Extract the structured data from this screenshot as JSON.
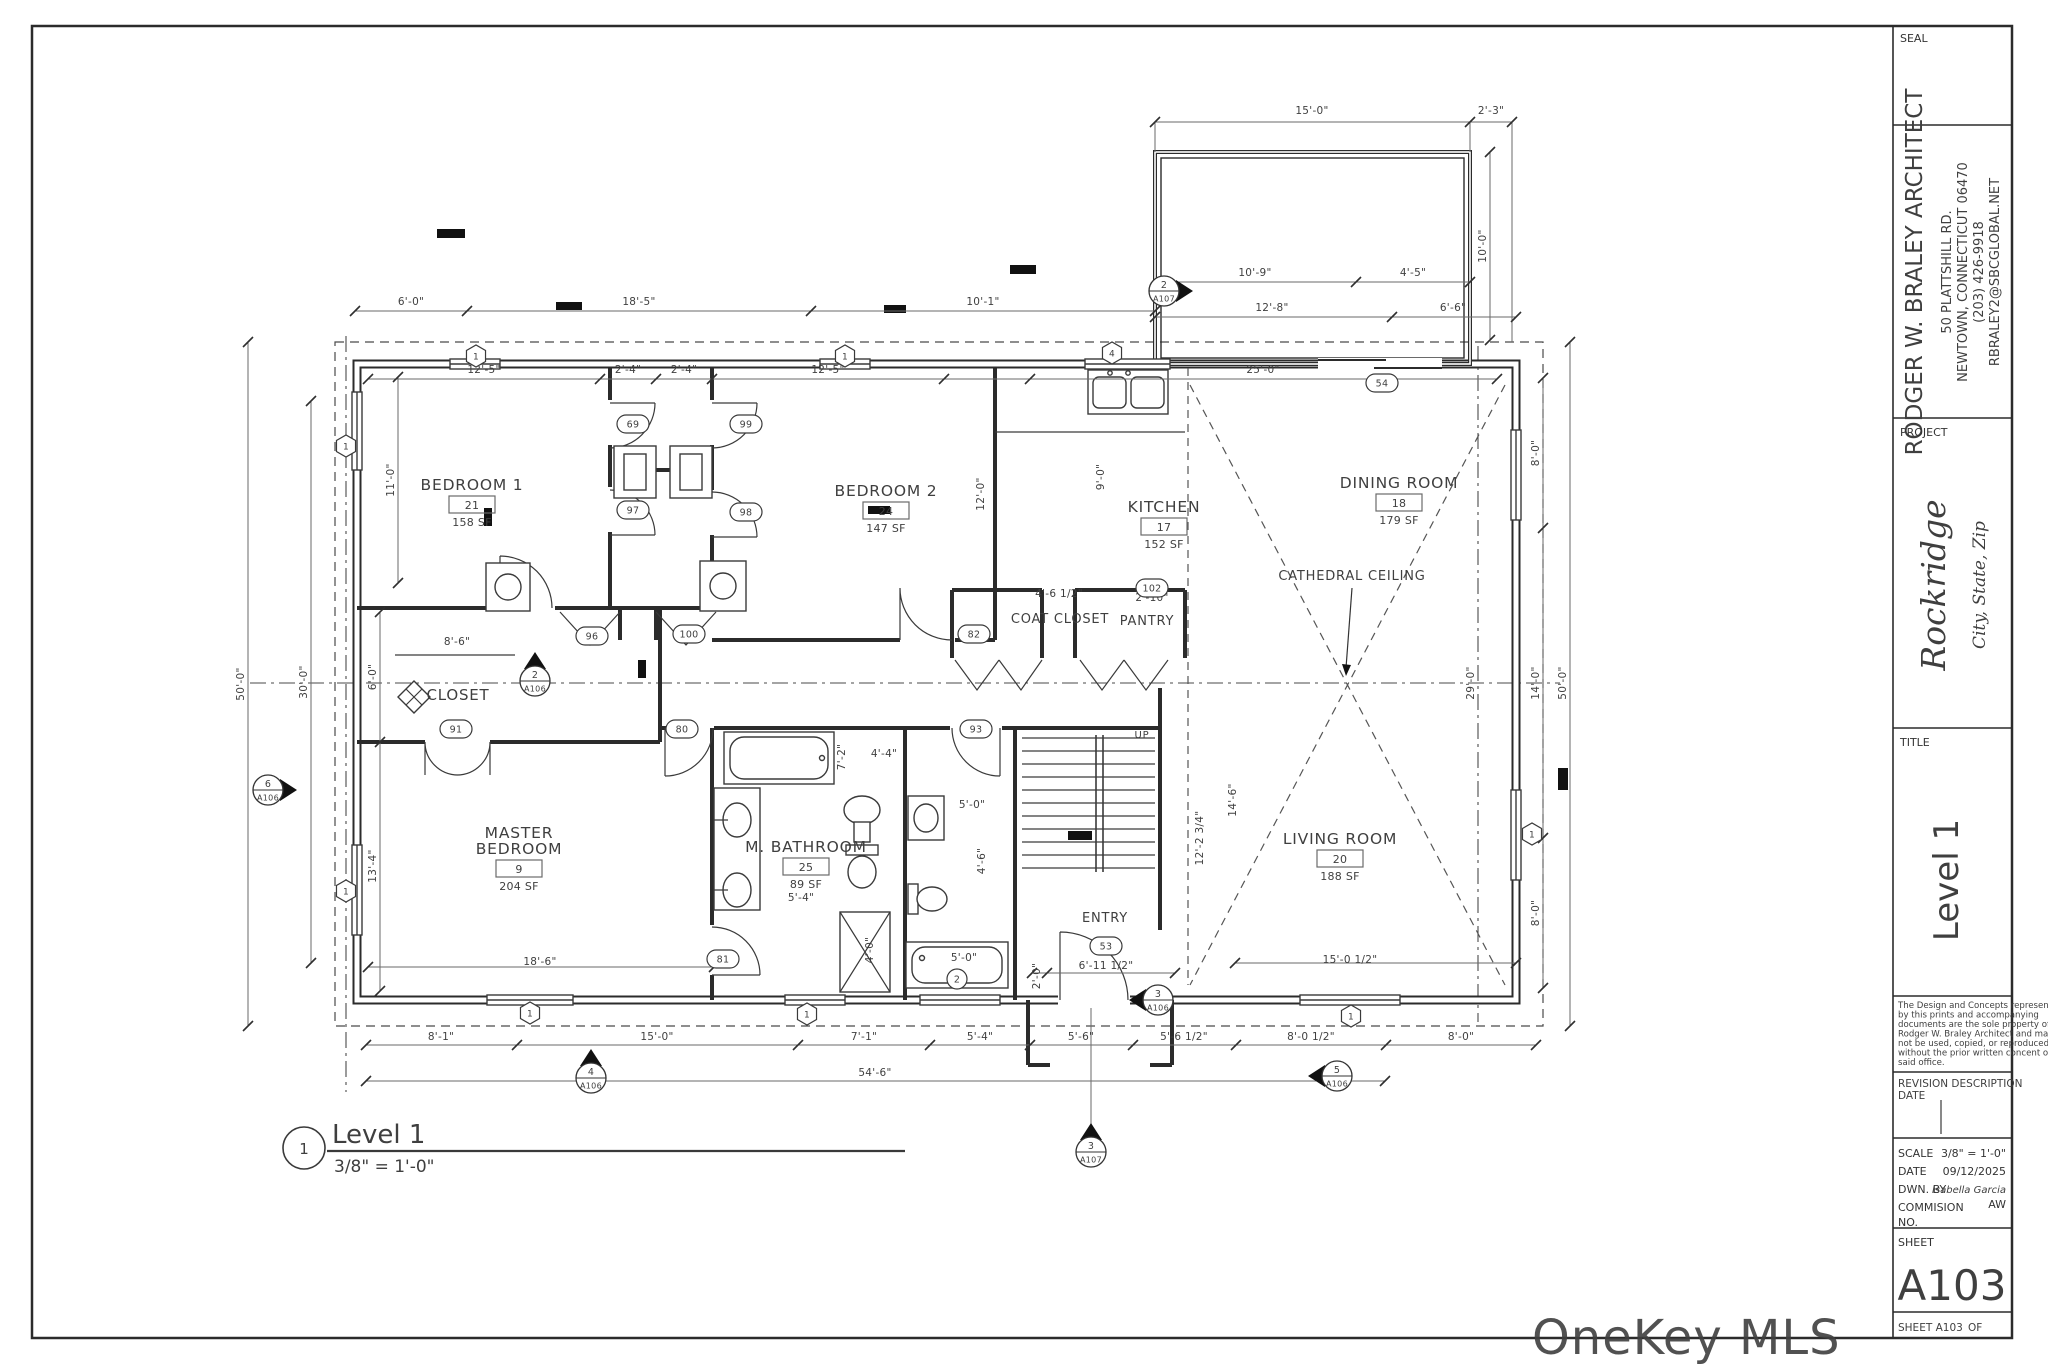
{
  "title_block": {
    "seal_label": "SEAL",
    "architect": {
      "name": "RODGER W. BRALEY ARCHITECT",
      "address1": "50 PLATTSHILL RD.",
      "address2": "NEWTOWN, CONNECTICUT 06470",
      "phone": "(203) 426-9918",
      "email": "RBRALEY2@SBCGLOBAL.NET"
    },
    "project_label": "PROJECT",
    "project_name": "Rockridge",
    "project_location": "City, State, Zip",
    "title_label": "TITLE",
    "sheet_title": "Level 1",
    "copyright_lines": [
      "The Design and Concepts represented",
      "by this prints and accompanying",
      "documents are the sole property of",
      "Rodger W. Braley Architect and may",
      "not be used, copied, or reproduced",
      "without the prior written concent of",
      "said office."
    ],
    "revision_header": "REVISION  DESCRIPTION",
    "date_header": "DATE",
    "scale_label": "SCALE",
    "scale_value": "3/8\" = 1'-0\"",
    "date_label": "DATE",
    "date_value": "09/12/2025",
    "drawn_by_label": "DWN. BY",
    "drawn_by_value": "Isabella Garcia",
    "commission_label": "COMMISION",
    "commission_no_label": "NO.",
    "commission_value": "AW",
    "sheet_label": "SHEET",
    "sheet_number": "A103",
    "footer_sheet": "SHEET A103",
    "footer_of": "OF"
  },
  "view_title": {
    "number": "1",
    "name": "Level 1",
    "scale": "3/8\" = 1'-0\""
  },
  "watermark": "OneKey MLS",
  "plan": {
    "rooms": [
      {
        "name": "BEDROOM 1",
        "tag": "21",
        "area": "158 SF",
        "x": 472,
        "y": 488
      },
      {
        "name": "BEDROOM 2",
        "tag": "24",
        "area": "147 SF",
        "x": 886,
        "y": 494
      },
      {
        "name": "KITCHEN",
        "tag": "17",
        "area": "152 SF",
        "x": 1164,
        "y": 510
      },
      {
        "name": "DINING ROOM",
        "tag": "18",
        "area": "179 SF",
        "x": 1399,
        "y": 486
      },
      {
        "name": "MASTER\nBEDROOM",
        "tag": "9",
        "area": "204 SF",
        "x": 519,
        "y": 852
      },
      {
        "name": "M. BATHROOM",
        "tag": "25",
        "area": "89 SF",
        "x": 806,
        "y": 850
      },
      {
        "name": "LIVING ROOM",
        "tag": "20",
        "area": "188 SF",
        "x": 1340,
        "y": 842
      }
    ],
    "labels": [
      {
        "t": "CLOSET",
        "x": 458,
        "y": 700,
        "s": 15
      },
      {
        "t": "COAT CLOSET",
        "x": 1060,
        "y": 623,
        "s": 13
      },
      {
        "t": "PANTRY",
        "x": 1147,
        "y": 625,
        "s": 13
      },
      {
        "t": "ENTRY",
        "x": 1105,
        "y": 922,
        "s": 13
      },
      {
        "t": "CATHEDRAL CEILING",
        "x": 1352,
        "y": 580,
        "s": 13
      },
      {
        "t": "UP",
        "x": 1142,
        "y": 738,
        "s": 10
      }
    ],
    "dims": [
      {
        "t": "15'-0\"",
        "x": 1312,
        "y": 114
      },
      {
        "t": "2'-3\"",
        "x": 1491,
        "y": 114
      },
      {
        "t": "10'-9\"",
        "x": 1255,
        "y": 276
      },
      {
        "t": "4'-5\"",
        "x": 1413,
        "y": 276
      },
      {
        "t": "12'-8\"",
        "x": 1272,
        "y": 311
      },
      {
        "t": "6'-6\"",
        "x": 1453,
        "y": 311
      },
      {
        "t": "10'-0\"",
        "x": 1486,
        "y": 246,
        "r": -90
      },
      {
        "t": "6'-0\"",
        "x": 411,
        "y": 305
      },
      {
        "t": "18'-5\"",
        "x": 639,
        "y": 305
      },
      {
        "t": "10'-1\"",
        "x": 983,
        "y": 305
      },
      {
        "t": "12'-5\"",
        "x": 484,
        "y": 373
      },
      {
        "t": "2'-4\"",
        "x": 628,
        "y": 373
      },
      {
        "t": "2'-4\"",
        "x": 684,
        "y": 373
      },
      {
        "t": "12'-5\"",
        "x": 828,
        "y": 373
      },
      {
        "t": "25'-0\"",
        "x": 1263,
        "y": 373
      },
      {
        "t": "50'-0\"",
        "x": 244,
        "y": 684,
        "r": -90
      },
      {
        "t": "30'-0\"",
        "x": 307,
        "y": 682,
        "r": -90
      },
      {
        "t": "11'-0\"",
        "x": 394,
        "y": 480,
        "r": -90
      },
      {
        "t": "6'-0\"",
        "x": 376,
        "y": 677,
        "r": -90
      },
      {
        "t": "13'-4\"",
        "x": 376,
        "y": 866,
        "r": -90
      },
      {
        "t": "8'-0\"",
        "x": 1539,
        "y": 453,
        "r": -90
      },
      {
        "t": "14'-0\"",
        "x": 1539,
        "y": 683,
        "r": -90
      },
      {
        "t": "8'-0\"",
        "x": 1539,
        "y": 913,
        "r": -90
      },
      {
        "t": "50'-0\"",
        "x": 1566,
        "y": 683,
        "r": -90
      },
      {
        "t": "29'-0\"",
        "x": 1474,
        "y": 683,
        "r": -90
      },
      {
        "t": "8'-6\"",
        "x": 457,
        "y": 645
      },
      {
        "t": "12'-0\"",
        "x": 984,
        "y": 494,
        "r": -90
      },
      {
        "t": "9'-0\"",
        "x": 1104,
        "y": 477,
        "r": -90
      },
      {
        "t": "4'-6 1/2\"",
        "x": 1059,
        "y": 597
      },
      {
        "t": "2'-10\"",
        "x": 1152,
        "y": 601
      },
      {
        "t": "4'-4\"",
        "x": 884,
        "y": 757
      },
      {
        "t": "7'-2\"",
        "x": 845,
        "y": 757,
        "r": -90
      },
      {
        "t": "5'-4\"",
        "x": 801,
        "y": 901
      },
      {
        "t": "5'-0\"",
        "x": 972,
        "y": 808
      },
      {
        "t": "4'-6\"",
        "x": 985,
        "y": 861,
        "r": -90
      },
      {
        "t": "5'-0\"",
        "x": 964,
        "y": 961
      },
      {
        "t": "4'-0\"",
        "x": 873,
        "y": 950,
        "r": -90
      },
      {
        "t": "2'-0\"",
        "x": 1040,
        "y": 976,
        "r": -90
      },
      {
        "t": "6'-11 1/2\"",
        "x": 1106,
        "y": 969
      },
      {
        "t": "18'-6\"",
        "x": 540,
        "y": 965
      },
      {
        "t": "12'-2 3/4\"",
        "x": 1203,
        "y": 838,
        "r": -90
      },
      {
        "t": "14'-6\"",
        "x": 1236,
        "y": 800,
        "r": -90
      },
      {
        "t": "15'-0 1/2\"",
        "x": 1350,
        "y": 963
      },
      {
        "t": "8'-1\"",
        "x": 441,
        "y": 1040
      },
      {
        "t": "15'-0\"",
        "x": 657,
        "y": 1040
      },
      {
        "t": "7'-1\"",
        "x": 864,
        "y": 1040
      },
      {
        "t": "5'-4\"",
        "x": 980,
        "y": 1040
      },
      {
        "t": "5'-6\"",
        "x": 1081,
        "y": 1040
      },
      {
        "t": "5'-6 1/2\"",
        "x": 1184,
        "y": 1040
      },
      {
        "t": "8'-0 1/2\"",
        "x": 1311,
        "y": 1040
      },
      {
        "t": "8'-0\"",
        "x": 1461,
        "y": 1040
      },
      {
        "t": "54'-6\"",
        "x": 875,
        "y": 1076
      }
    ],
    "door_tags": [
      {
        "t": "69",
        "x": 633,
        "y": 424
      },
      {
        "t": "97",
        "x": 633,
        "y": 510
      },
      {
        "t": "99",
        "x": 746,
        "y": 424
      },
      {
        "t": "98",
        "x": 746,
        "y": 512
      },
      {
        "t": "96",
        "x": 592,
        "y": 636
      },
      {
        "t": "100",
        "x": 689,
        "y": 634
      },
      {
        "t": "91",
        "x": 456,
        "y": 729
      },
      {
        "t": "80",
        "x": 682,
        "y": 729
      },
      {
        "t": "82",
        "x": 974,
        "y": 634
      },
      {
        "t": "93",
        "x": 976,
        "y": 729
      },
      {
        "t": "81",
        "x": 723,
        "y": 959
      },
      {
        "t": "53",
        "x": 1106,
        "y": 946
      },
      {
        "t": "54",
        "x": 1382,
        "y": 383
      },
      {
        "t": "102",
        "x": 1152,
        "y": 588
      },
      {
        "t": "2",
        "x": 957,
        "y": 979
      }
    ],
    "window_tags": [
      {
        "t": "1",
        "x": 346,
        "y": 446
      },
      {
        "t": "1",
        "x": 346,
        "y": 891
      },
      {
        "t": "1",
        "x": 476,
        "y": 356
      },
      {
        "t": "1",
        "x": 845,
        "y": 356
      },
      {
        "t": "4",
        "x": 1112,
        "y": 353
      },
      {
        "t": "1",
        "x": 1532,
        "y": 834
      },
      {
        "t": "1",
        "x": 1351,
        "y": 1016
      },
      {
        "t": "1",
        "x": 530,
        "y": 1013
      },
      {
        "t": "1",
        "x": 807,
        "y": 1014
      }
    ],
    "sections": [
      {
        "n": "6",
        "s": "A106",
        "x": 268,
        "y": 790,
        "dir": "right"
      },
      {
        "n": "2",
        "s": "A106",
        "x": 535,
        "y": 681,
        "dir": "up"
      },
      {
        "n": "4",
        "s": "A106",
        "x": 591,
        "y": 1078,
        "dir": "up"
      },
      {
        "n": "3",
        "s": "A106",
        "x": 1158,
        "y": 1000,
        "dir": "left"
      },
      {
        "n": "5",
        "s": "A106",
        "x": 1337,
        "y": 1076,
        "dir": "left"
      },
      {
        "n": "3",
        "s": "A107",
        "x": 1091,
        "y": 1152,
        "dir": "up"
      },
      {
        "n": "2",
        "s": "A107",
        "x": 1164,
        "y": 291,
        "dir": "right"
      }
    ]
  }
}
